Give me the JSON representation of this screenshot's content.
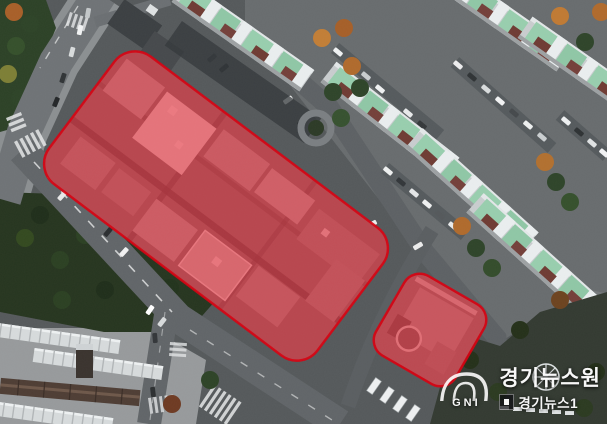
{
  "watermark": {
    "brand": "GNI",
    "title": "경기뉴스원",
    "subtitle": "경기뉴스1"
  },
  "overlay": {
    "fill": "#e8000d",
    "fill_opacity": 0.5,
    "stroke": "#d7000f",
    "stroke_opacity": 0.9,
    "stroke_width": 2.5,
    "regions": [
      {
        "name": "main-site-highlight",
        "cx": 216,
        "cy": 206,
        "width": 336,
        "height": 160,
        "radius": 26,
        "rotation": 37
      },
      {
        "name": "annex-site-highlight",
        "cx": 430,
        "cy": 330,
        "width": 92,
        "height": 92,
        "radius": 18,
        "rotation": 30
      }
    ]
  }
}
